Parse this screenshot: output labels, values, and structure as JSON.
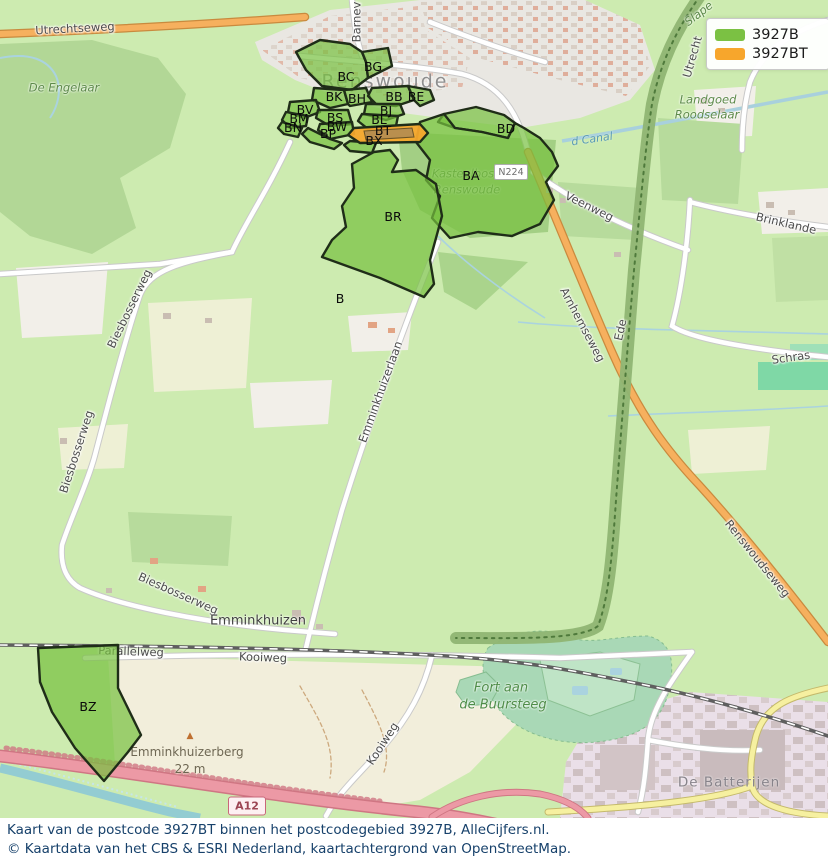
{
  "legend": {
    "items": [
      {
        "label": "3927B",
        "color": "#7bc143"
      },
      {
        "label": "3927BT",
        "color": "#f7a62c"
      }
    ]
  },
  "caption": {
    "line1": "Kaart van de postcode 3927BT binnen het postcodegebied 3927B, AlleCijfers.nl.",
    "line2": "© Kaartdata van het CBS & ESRI Nederland, kaartachtergrond van OpenStreetMap."
  },
  "map": {
    "shields": {
      "n224": "N224",
      "a12": "A12"
    },
    "peak": {
      "name": "Emminkhuizerberg",
      "elevation": "22 m",
      "marker": "▲"
    },
    "regions": [
      {
        "code": "BC",
        "x": 346,
        "y": 77
      },
      {
        "code": "BG",
        "x": 373,
        "y": 67
      },
      {
        "code": "BK",
        "x": 334,
        "y": 97
      },
      {
        "code": "BH",
        "x": 357,
        "y": 99
      },
      {
        "code": "BB",
        "x": 394,
        "y": 97
      },
      {
        "code": "BE",
        "x": 416,
        "y": 97
      },
      {
        "code": "BV",
        "x": 305,
        "y": 110
      },
      {
        "code": "BM",
        "x": 299,
        "y": 119
      },
      {
        "code": "BN",
        "x": 293,
        "y": 128
      },
      {
        "code": "BS",
        "x": 335,
        "y": 118
      },
      {
        "code": "BW",
        "x": 337,
        "y": 127
      },
      {
        "code": "BP",
        "x": 328,
        "y": 134
      },
      {
        "code": "BJ",
        "x": 386,
        "y": 111
      },
      {
        "code": "BL",
        "x": 379,
        "y": 120
      },
      {
        "code": "BT",
        "x": 383,
        "y": 131
      },
      {
        "code": "BX",
        "x": 374,
        "y": 141
      },
      {
        "code": "BD",
        "x": 506,
        "y": 129
      },
      {
        "code": "BA",
        "x": 471,
        "y": 176
      },
      {
        "code": "BR",
        "x": 393,
        "y": 217
      },
      {
        "code": "B",
        "x": 340,
        "y": 299
      },
      {
        "code": "BZ",
        "x": 88,
        "y": 707
      }
    ],
    "labels": [
      {
        "text": "Utrechtseweg",
        "x": 75,
        "y": 29,
        "rot": -3,
        "cls": "road"
      },
      {
        "text": "De Engelaar",
        "x": 64,
        "y": 88,
        "rot": 0,
        "cls": "green"
      },
      {
        "text": "Barnev",
        "x": 357,
        "y": 22,
        "rot": -90,
        "cls": "road"
      },
      {
        "text": "Renswoude",
        "x": 385,
        "y": 82,
        "rot": 0,
        "cls": "town"
      },
      {
        "text": "Slape",
        "x": 699,
        "y": 14,
        "rot": -38,
        "cls": "green"
      },
      {
        "text": "Utrecht",
        "x": 693,
        "y": 57,
        "rot": -74,
        "cls": "road"
      },
      {
        "text": "Landgoed",
        "x": 708,
        "y": 100,
        "rot": 0,
        "cls": "green"
      },
      {
        "text": "Roodselaar",
        "x": 707,
        "y": 115,
        "rot": 0,
        "cls": "green"
      },
      {
        "text": "d Canal",
        "x": 592,
        "y": 139,
        "rot": -8,
        "cls": "water"
      },
      {
        "text": "Kasteelbos",
        "x": 463,
        "y": 174,
        "rot": 0,
        "cls": "green"
      },
      {
        "text": "Renswoude",
        "x": 467,
        "y": 190,
        "rot": 0,
        "cls": "green"
      },
      {
        "text": "Veenweg",
        "x": 589,
        "y": 207,
        "rot": 26,
        "cls": "road"
      },
      {
        "text": "Brinklande",
        "x": 786,
        "y": 224,
        "rot": 13,
        "cls": "road"
      },
      {
        "text": "Ede",
        "x": 621,
        "y": 330,
        "rot": -78,
        "cls": "road"
      },
      {
        "text": "Schras",
        "x": 791,
        "y": 358,
        "rot": -8,
        "cls": "road"
      },
      {
        "text": "Arnhemseweg",
        "x": 582,
        "y": 325,
        "rot": 62,
        "cls": "road"
      },
      {
        "text": "Renswoudseweg",
        "x": 757,
        "y": 559,
        "rot": 51,
        "cls": "road"
      },
      {
        "text": "Biesbosserweg",
        "x": 130,
        "y": 309,
        "rot": -64,
        "cls": "road"
      },
      {
        "text": "Biesbosserweg",
        "x": 77,
        "y": 452,
        "rot": -72,
        "cls": "road"
      },
      {
        "text": "Biesbosserweg",
        "x": 178,
        "y": 594,
        "rot": 24,
        "cls": "road"
      },
      {
        "text": "Emminkhuizerlaan",
        "x": 381,
        "y": 392,
        "rot": -70,
        "cls": "road"
      },
      {
        "text": "Emminkhuizen",
        "x": 258,
        "y": 621,
        "rot": 0,
        "cls": "hamlet"
      },
      {
        "text": "Parallelweg",
        "x": 131,
        "y": 652,
        "rot": 2,
        "cls": "road"
      },
      {
        "text": "Kooiweg",
        "x": 263,
        "y": 658,
        "rot": 2,
        "cls": "road"
      },
      {
        "text": "Kooiweg",
        "x": 383,
        "y": 744,
        "rot": -57,
        "cls": "road"
      },
      {
        "text": "Emminkhuizerberg",
        "x": 187,
        "y": 752,
        "rot": 0,
        "cls": "peak"
      },
      {
        "text": "22 m",
        "x": 190,
        "y": 769,
        "rot": 0,
        "cls": "peak"
      },
      {
        "text": "Fort aan",
        "x": 501,
        "y": 688,
        "rot": 0,
        "cls": "green-lg"
      },
      {
        "text": "de Buursteeg",
        "x": 503,
        "y": 705,
        "rot": 0,
        "cls": "green-lg"
      },
      {
        "text": "De Batterijen",
        "x": 729,
        "y": 783,
        "rot": 0,
        "cls": "gray"
      }
    ]
  }
}
